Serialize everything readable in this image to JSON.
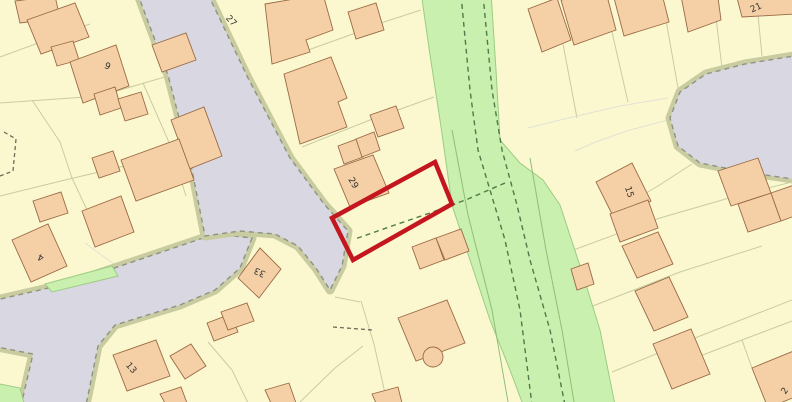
{
  "map": {
    "canvas": {
      "width": 792,
      "height": 402
    },
    "colors": {
      "background": "#fbf8d0",
      "road_fill": "#d9d8e2",
      "verge": "#c9cba0",
      "road_dash": "#8f9383",
      "building_fill": "#f5d0a6",
      "building_stroke": "#9a6a44",
      "parcel_line": "#c9cc9e",
      "faint_line": "#e2e2d4",
      "green_fill": "#c9f0ae",
      "green_line": "#8fbf77",
      "green_inner_line": "#9ccc84",
      "green_dash": "#4f7a4a",
      "boundary_dash": "#6b6b5a",
      "plot_outline": "#c3161e",
      "label_color": "#333333"
    },
    "roads": [
      {
        "name": "road-main",
        "points": "-8,301 70,283 150,256 215,234 252,238 240,268 215,290 180,305 115,325 98,346 85,410 20,410 33,354 -8,346"
      },
      {
        "name": "road-north",
        "points": "137,-8 207,-8 248,78 290,158 324,204 348,231 342,266 330,290 316,268 298,246 275,234 240,231 205,236 190,160 168,75"
      },
      {
        "name": "road-culdesac",
        "points": "800,55 745,64 706,74 680,92 670,118 678,146 700,163 745,172 800,180"
      }
    ],
    "green_areas": [
      {
        "name": "green-strip",
        "points": "421,-8 491,-8 496,70 500,140 520,163 543,180 560,205 583,275 600,330 616,410 525,410 510,370 490,320 470,260 452,205 445,155 440,120 430,55"
      },
      {
        "name": "green-wedge",
        "points": "45,284 112,266 118,276 52,292"
      },
      {
        "name": "green-corner",
        "points": "-5,383 20,388 26,410 -5,410"
      }
    ],
    "green_lines": [
      {
        "points": "452,130 468,215 492,310 508,402"
      },
      {
        "points": "530,158 546,250 562,330 574,402"
      }
    ],
    "green_dashes": [
      {
        "name": "path-dash-left",
        "points": "461,-5 470,90 478,150 490,190 505,240 520,310 532,405"
      },
      {
        "name": "path-dash-right",
        "points": "483,-5 492,90 502,150 517,205 530,260 550,330 565,405"
      },
      {
        "name": "path-dash-crossing",
        "points": "505,183 468,199 430,213 392,226 355,239"
      }
    ],
    "parcel_lines": [
      {
        "points": "0,103 100,96 168,76"
      },
      {
        "points": "0,196 65,180 150,160"
      },
      {
        "points": "32,100 60,142 72,178 88,212 98,228"
      },
      {
        "points": "143,83 168,140 186,196"
      },
      {
        "points": "90,24 0,57"
      },
      {
        "points": "272,63 350,35 384,22 421,10"
      },
      {
        "points": "302,147 370,120 434,97"
      },
      {
        "points": "361,301 374,344 387,402"
      },
      {
        "points": "335,297 360,302"
      },
      {
        "points": "208,342 232,370 248,403"
      },
      {
        "points": "300,402 335,368 363,346"
      },
      {
        "points": "563,44 577,118"
      },
      {
        "points": "612,32 628,102"
      },
      {
        "points": "666,20 678,88"
      },
      {
        "points": "716,18 722,68"
      },
      {
        "points": "758,15 762,56"
      },
      {
        "points": "692,164 658,186 634,200"
      },
      {
        "points": "560,255 660,218 736,196"
      },
      {
        "points": "580,311 680,272 762,246"
      },
      {
        "points": "612,372 700,336 792,300"
      },
      {
        "points": "736,196 800,180"
      },
      {
        "points": "700,356 742,340 800,318"
      },
      {
        "points": "742,340 752,368"
      },
      {
        "points": "528,128 560,120 620,106 668,98",
        "faint": true
      },
      {
        "points": "668,120 630,130 598,141 575,151",
        "faint": true
      },
      {
        "points": "85,243 150,290 205,236",
        "faint": true
      }
    ],
    "boundary_dashes": [
      {
        "points": "4,132 16,139 13,171 0,176"
      },
      {
        "points": "333,327 372,330"
      }
    ],
    "buildings": [
      {
        "points": "15,1 55,-4 60,18 20,23"
      },
      {
        "points": "27,20 75,3 89,37 41,54"
      },
      {
        "points": "51,47 73,41 79,60 57,66"
      },
      {
        "points": "70,62 116,45 129,86 83,103"
      },
      {
        "points": "94,94 115,87 121,108 100,115"
      },
      {
        "points": "118,99 141,92 148,114 125,121"
      },
      {
        "points": "152,45 186,33 196,60 162,72"
      },
      {
        "points": "171,120 204,107 222,156 189,169"
      },
      {
        "points": "92,158 113,151 120,171 99,178"
      },
      {
        "points": "121,160 179,139 194,180 136,201"
      },
      {
        "points": "33,201 61,192 68,213 40,222"
      },
      {
        "points": "82,211 121,196 134,232 95,247"
      },
      {
        "points": "12,240 48,224 67,266 31,282"
      },
      {
        "points": "113,355 156,340 170,376 127,391"
      },
      {
        "points": "170,356 191,344 206,366 185,379"
      },
      {
        "points": "160,394 181,387 187,403 165,403"
      },
      {
        "points": "238,278 260,248 281,269 259,298"
      },
      {
        "points": "207,323 231,314 238,332 214,341"
      },
      {
        "points": "221,312 247,303 254,321 228,330"
      },
      {
        "points": "265,4 323,-6 333,30 306,40 310,52 272,64"
      },
      {
        "points": "348,12 376,3 384,30 356,39"
      },
      {
        "points": "284,74 331,57 347,98 338,102 347,127 300,144"
      },
      {
        "points": "370,115 396,106 404,128 378,137"
      },
      {
        "points": "338,146 357,139 363,157 344,164"
      },
      {
        "points": "356,139 374,132 380,150 362,157"
      },
      {
        "points": "334,169 373,155 389,193 350,207"
      },
      {
        "points": "412,247 436,238 444,260 420,269"
      },
      {
        "points": "436,238 461,229 469,251 445,260"
      },
      {
        "points": "398,318 447,300 465,343 416,361"
      },
      {
        "points": "372,394 398,387 402,403 376,403"
      },
      {
        "points": "265,390 289,383 296,403 271,403"
      },
      {
        "points": "528,9 557,-2 571,40 542,52"
      },
      {
        "points": "561,0 606,-8 616,30 574,45"
      },
      {
        "points": "614,-2 661,-10 669,22 624,36"
      },
      {
        "points": "681,-4 717,-10 721,20 688,32"
      },
      {
        "points": "736,-6 790,-14 796,14 742,17"
      },
      {
        "points": "596,182 632,163 651,201 615,220"
      },
      {
        "points": "610,214 648,200 658,228 620,242"
      },
      {
        "points": "622,246 658,232 673,264 637,278"
      },
      {
        "points": "571,269 588,263 594,284 577,290"
      },
      {
        "points": "635,291 669,277 688,317 654,331"
      },
      {
        "points": "653,344 691,329 710,374 672,389"
      },
      {
        "points": "752,368 796,350 812,390 768,408"
      },
      {
        "points": "738,204 771,193 781,221 748,232"
      },
      {
        "points": "771,193 800,183 800,214 781,221"
      },
      {
        "points": "718,171 758,158 771,193 731,206"
      }
    ],
    "building_circles": [
      {
        "cx": 433,
        "cy": 357,
        "r": 10
      }
    ],
    "plot": {
      "points": "435,162 452,204 353,260 332,218",
      "stroke_width": 4.5
    },
    "labels": [
      {
        "text": "27",
        "x": 231,
        "y": 21,
        "rot": 48
      },
      {
        "text": "6",
        "x": 108,
        "y": 65,
        "rot": 205
      },
      {
        "text": "29",
        "x": 353,
        "y": 183,
        "rot": 60
      },
      {
        "text": "33",
        "x": 260,
        "y": 272,
        "rot": 205
      },
      {
        "text": "4",
        "x": 41,
        "y": 257,
        "rot": 205
      },
      {
        "text": "13",
        "x": 131,
        "y": 368,
        "rot": 50
      },
      {
        "text": "15",
        "x": 629,
        "y": 192,
        "rot": 72
      },
      {
        "text": "21",
        "x": 756,
        "y": 8,
        "rot": -25
      },
      {
        "text": "2",
        "x": 785,
        "y": 391,
        "rot": -55
      }
    ]
  }
}
